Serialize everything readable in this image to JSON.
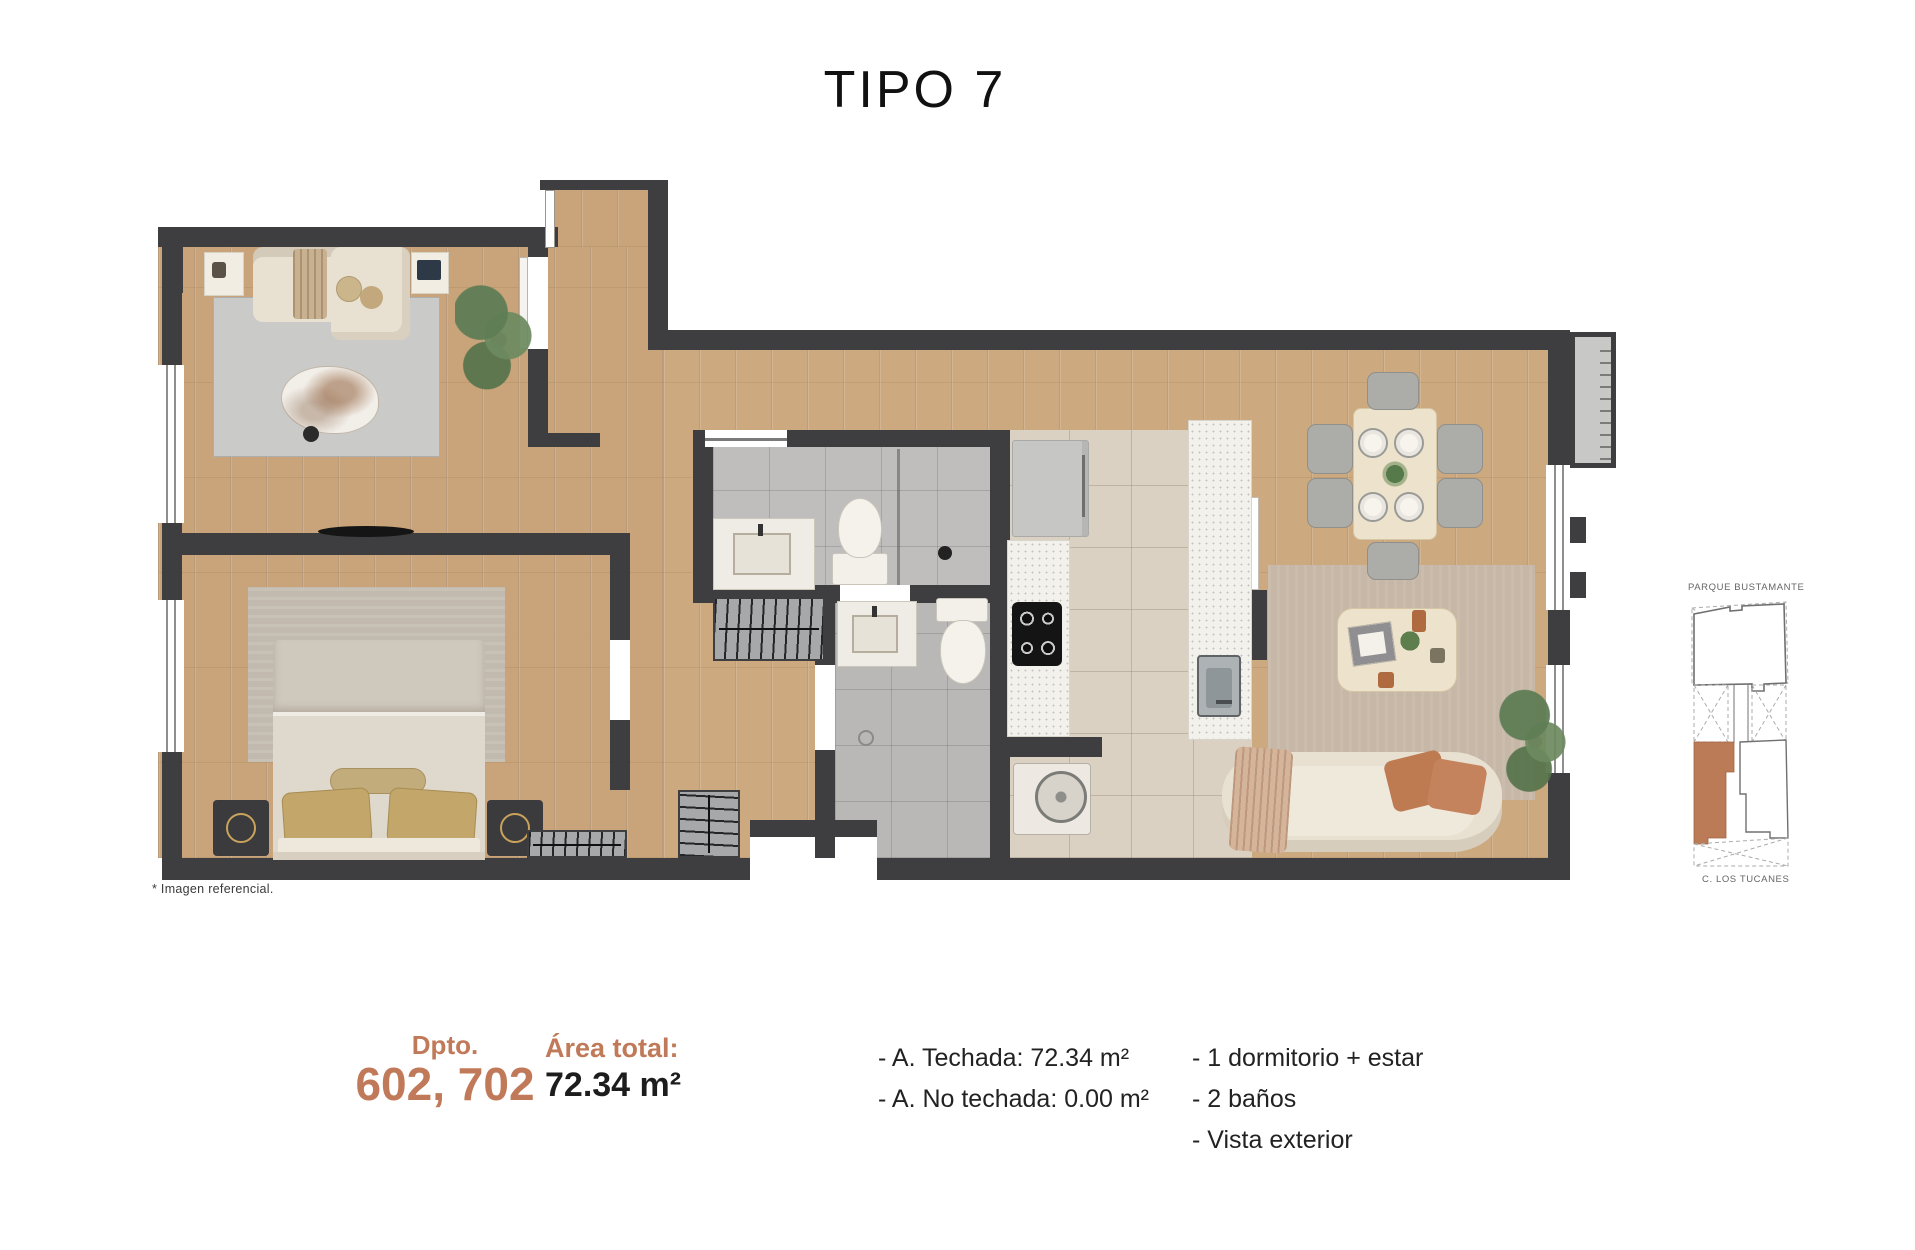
{
  "title": "TIPO 7",
  "footnote": "* Imagen referencial.",
  "colors": {
    "accent": "#C07A59",
    "wall": "#3E3E40",
    "wood": "#C9A47A",
    "wood_alt": "#CDA980",
    "tile_grey": "#C0BEBC",
    "tile_beige": "#DAD1C3",
    "counter": "#F3F1EC",
    "cream": "#E8E1D2",
    "rug_grey": "#CACBC9",
    "rug_taupe": "#C6B7A6",
    "bed_rug": "#C2BAAE",
    "gold": "#C3A66A",
    "green": "#64815A",
    "terracotta": "#BE7A51",
    "highlight": "#BC7B57",
    "text_dark": "#1D1D1D"
  },
  "minimap": {
    "top_label": "PARQUE BUSTAMANTE",
    "bottom_label": "C. LOS TUCANES",
    "highlight_color": "#BC7B57"
  },
  "footer": {
    "dpto_label": "Dpto.",
    "dpto_numbers": "602, 702",
    "area_label": "Área total:",
    "area_value": "72.34 m²",
    "details": [
      "- A. Techada: 72.34 m²",
      "- A. No techada: 0.00 m²"
    ],
    "features": [
      "- 1 dormitorio + estar",
      "- 2 baños",
      "- Vista exterior"
    ]
  }
}
